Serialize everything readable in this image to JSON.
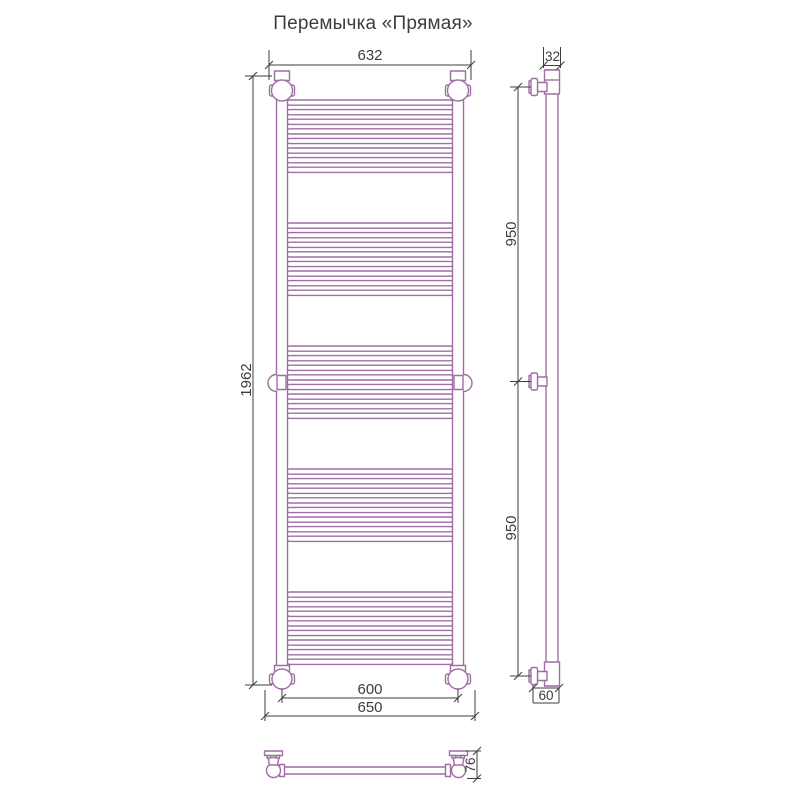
{
  "title": "Перемычка «Прямая»",
  "colors": {
    "drawing": "#9e6fa3",
    "dimension": "#3d3d3d",
    "background": "#ffffff"
  },
  "front_view": {
    "dim_top_width": "632",
    "dim_height": "1962",
    "dim_axis_width": "600",
    "dim_overall_width": "650"
  },
  "side_view": {
    "dim_tube_diameter": "32",
    "dim_upper_span": "950",
    "dim_lower_span": "950",
    "dim_wall_offset": "60"
  },
  "plan_view": {
    "dim_depth": "76"
  }
}
